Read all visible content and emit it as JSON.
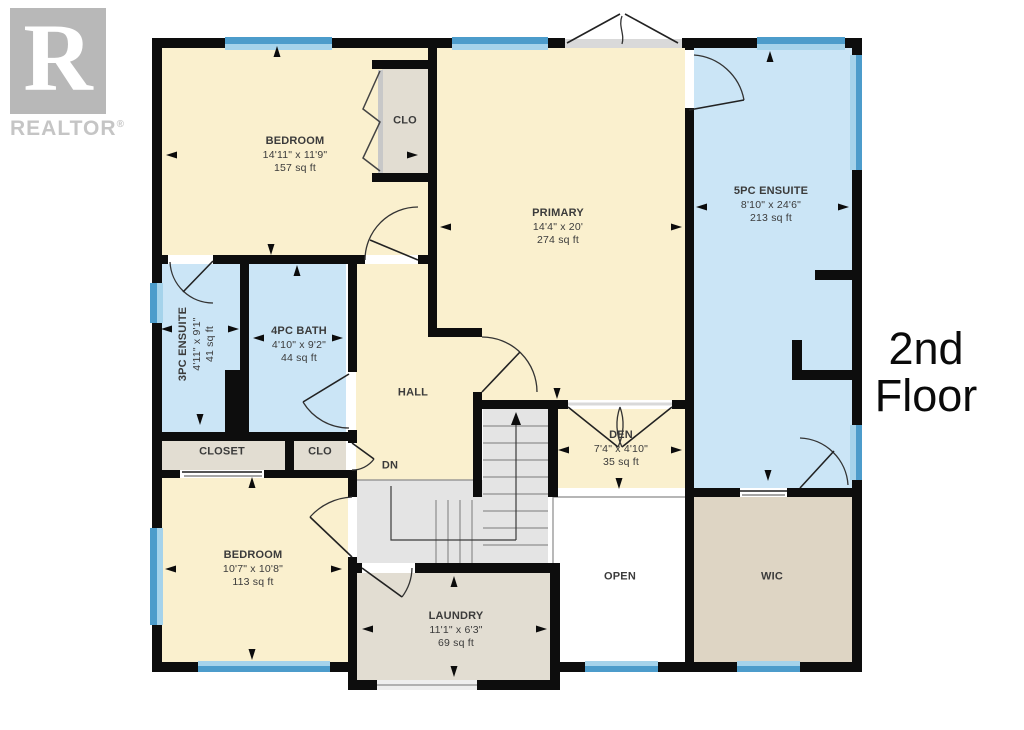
{
  "logo": {
    "letter": "R",
    "label": "REALTOR",
    "registered": "®"
  },
  "floor_title": {
    "line1": "2nd",
    "line2": "Floor"
  },
  "rooms": {
    "bedroom_top": {
      "name": "BEDROOM",
      "dims": "14'11\" x 11'9\"",
      "area": "157 sq ft"
    },
    "closet_top": {
      "name": "CLO"
    },
    "primary": {
      "name": "PRIMARY",
      "dims": "14'4\" x 20'",
      "area": "274 sq ft"
    },
    "ensuite_5pc": {
      "name": "5PC ENSUITE",
      "dims": "8'10\" x 24'6\"",
      "area": "213 sq ft"
    },
    "ensuite_3pc": {
      "name": "3PC ENSUITE",
      "dims": "4'11\" x 9'1\"",
      "area": "41 sq ft"
    },
    "bath_4pc": {
      "name": "4PC BATH",
      "dims": "4'10\" x 9'2\"",
      "area": "44 sq ft"
    },
    "hall": {
      "name": "HALL"
    },
    "closet": {
      "name": "CLOSET"
    },
    "closet_mid": {
      "name": "CLO"
    },
    "stairs": {
      "name": "DN"
    },
    "den": {
      "name": "DEN",
      "dims": "7'4\" x 4'10\"",
      "area": "35 sq ft"
    },
    "bedroom_bot": {
      "name": "BEDROOM",
      "dims": "10'7\" x 10'8\"",
      "area": "113 sq ft"
    },
    "laundry": {
      "name": "LAUNDRY",
      "dims": "11'1\" x 6'3\"",
      "area": "69 sq ft"
    },
    "open": {
      "name": "OPEN"
    },
    "wic": {
      "name": "WIC"
    }
  },
  "colors": {
    "room_cream": "#FAF0CE",
    "room_blue": "#CBE5F6",
    "room_gray": "#E2DDD2",
    "room_tan": "#DED5C4",
    "stairs": "#E4E4E4",
    "wall": "#0D0D0D",
    "window_dark": "#4C9CCB",
    "window_light": "#A5D3EB"
  }
}
